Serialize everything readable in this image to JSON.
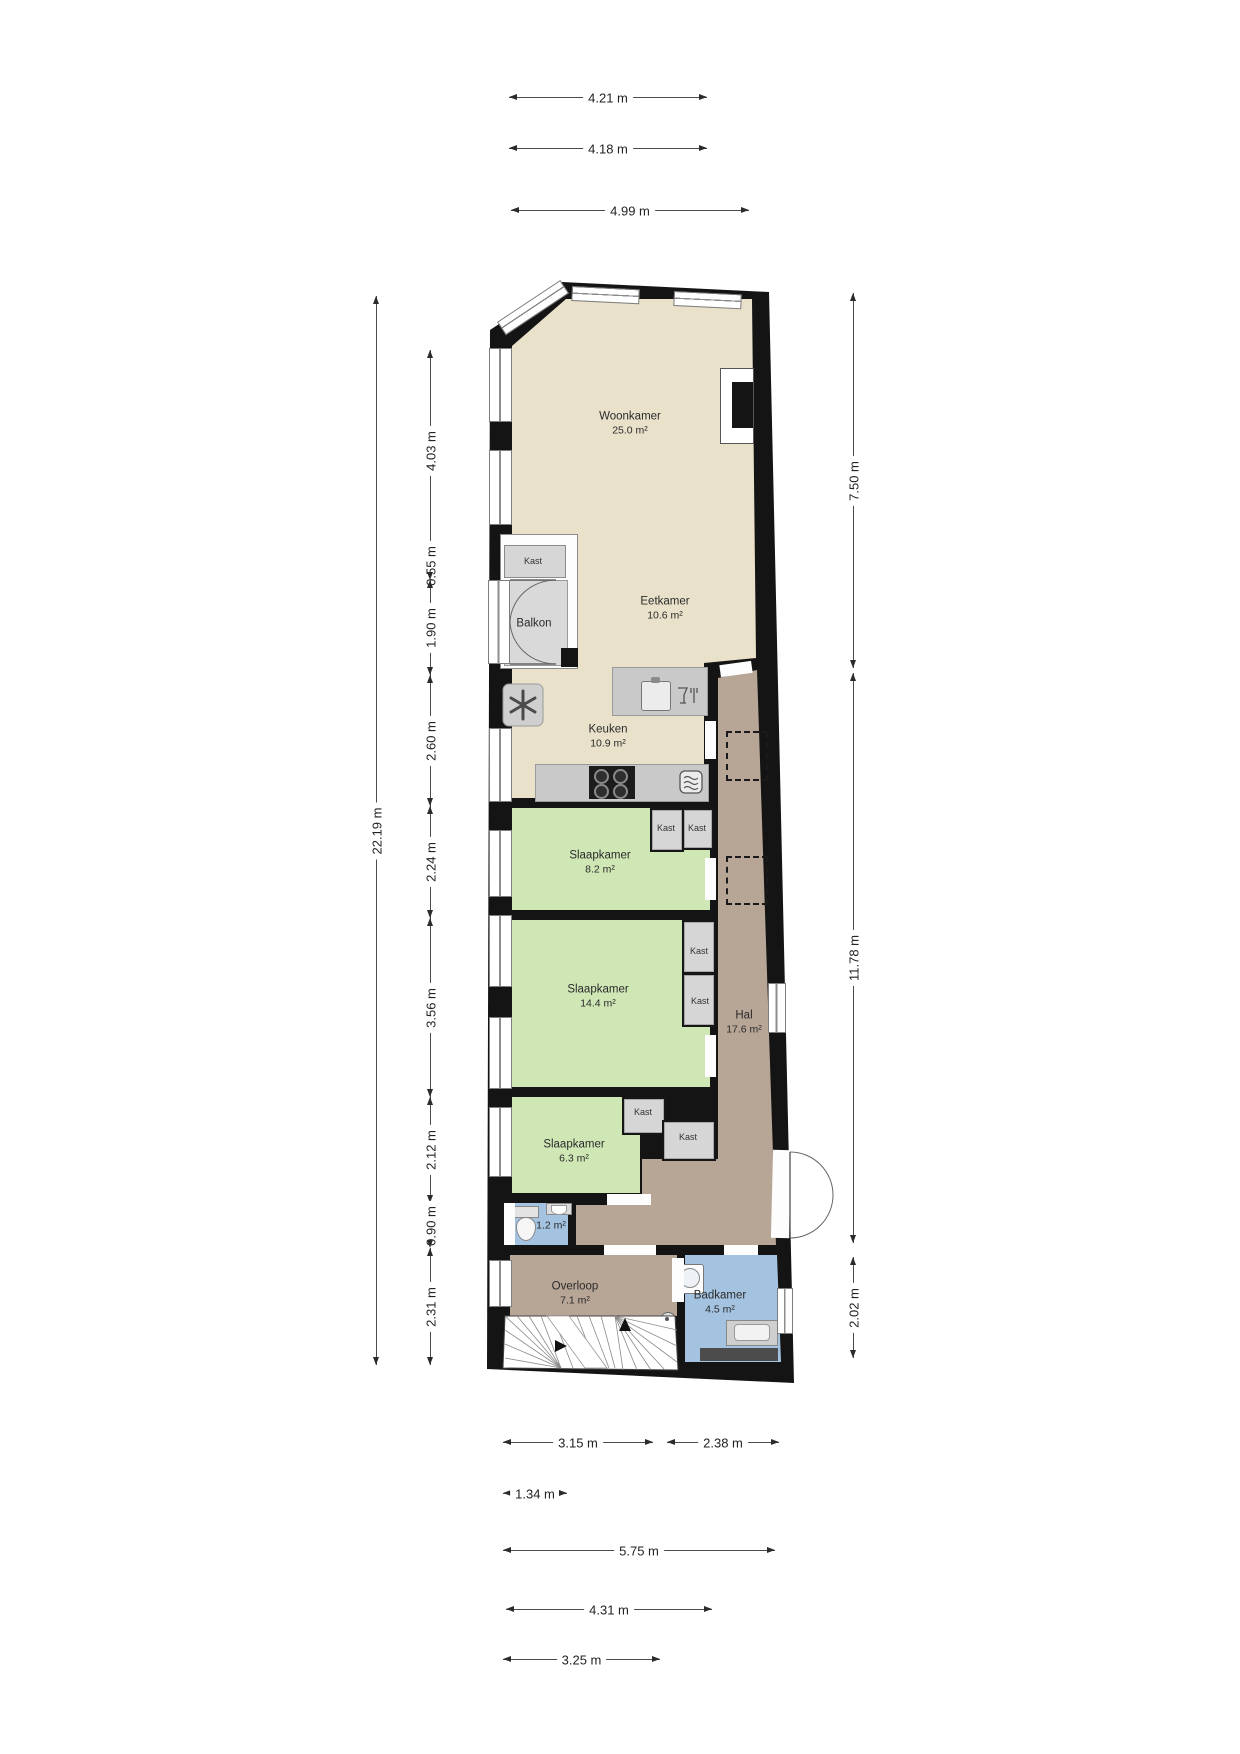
{
  "plan": {
    "type": "floor-plan",
    "colors": {
      "wall": "#141414",
      "living_floor": "#e9e1ca",
      "bedroom_floor": "#cfe6b5",
      "hall_floor": "#b7a596",
      "bath_floor": "#a4c3e0",
      "closet_gray": "#d6d6d6",
      "counter_gray": "#c9c9c9"
    },
    "labels": {
      "kast": "Kast"
    },
    "rooms": {
      "woonkamer": {
        "name": "Woonkamer",
        "area": "25.0 m²"
      },
      "eetkamer": {
        "name": "Eetkamer",
        "area": "10.6 m²"
      },
      "keuken": {
        "name": "Keuken",
        "area": "10.9 m²"
      },
      "slaapkamer_1": {
        "name": "Slaapkamer",
        "area": "8.2 m²"
      },
      "slaapkamer_2": {
        "name": "Slaapkamer",
        "area": "14.4 m²"
      },
      "slaapkamer_3": {
        "name": "Slaapkamer",
        "area": "6.3 m²"
      },
      "hal": {
        "name": "Hal",
        "area": "17.6 m²"
      },
      "overloop": {
        "name": "Overloop",
        "area": "7.1 m²"
      },
      "badkamer": {
        "name": "Badkamer",
        "area": "4.5 m²"
      },
      "wc": {
        "area": "1.2 m²"
      },
      "balkon": {
        "name": "Balkon"
      }
    },
    "dimensions": {
      "top": [
        "4.21 m",
        "4.18 m",
        "4.99 m"
      ],
      "bottom": [
        "3.15 m",
        "2.38 m",
        "1.34 m",
        "5.75 m",
        "4.31 m",
        "3.25 m"
      ],
      "left_overall": "22.19 m",
      "left": [
        "4.03 m",
        "0.55 m",
        "1.90 m",
        "2.60 m",
        "2.24 m",
        "3.56 m",
        "2.12 m",
        "0.90 m",
        "2.31 m"
      ],
      "right": [
        "7.50 m",
        "11.78 m",
        "2.02 m"
      ]
    }
  }
}
